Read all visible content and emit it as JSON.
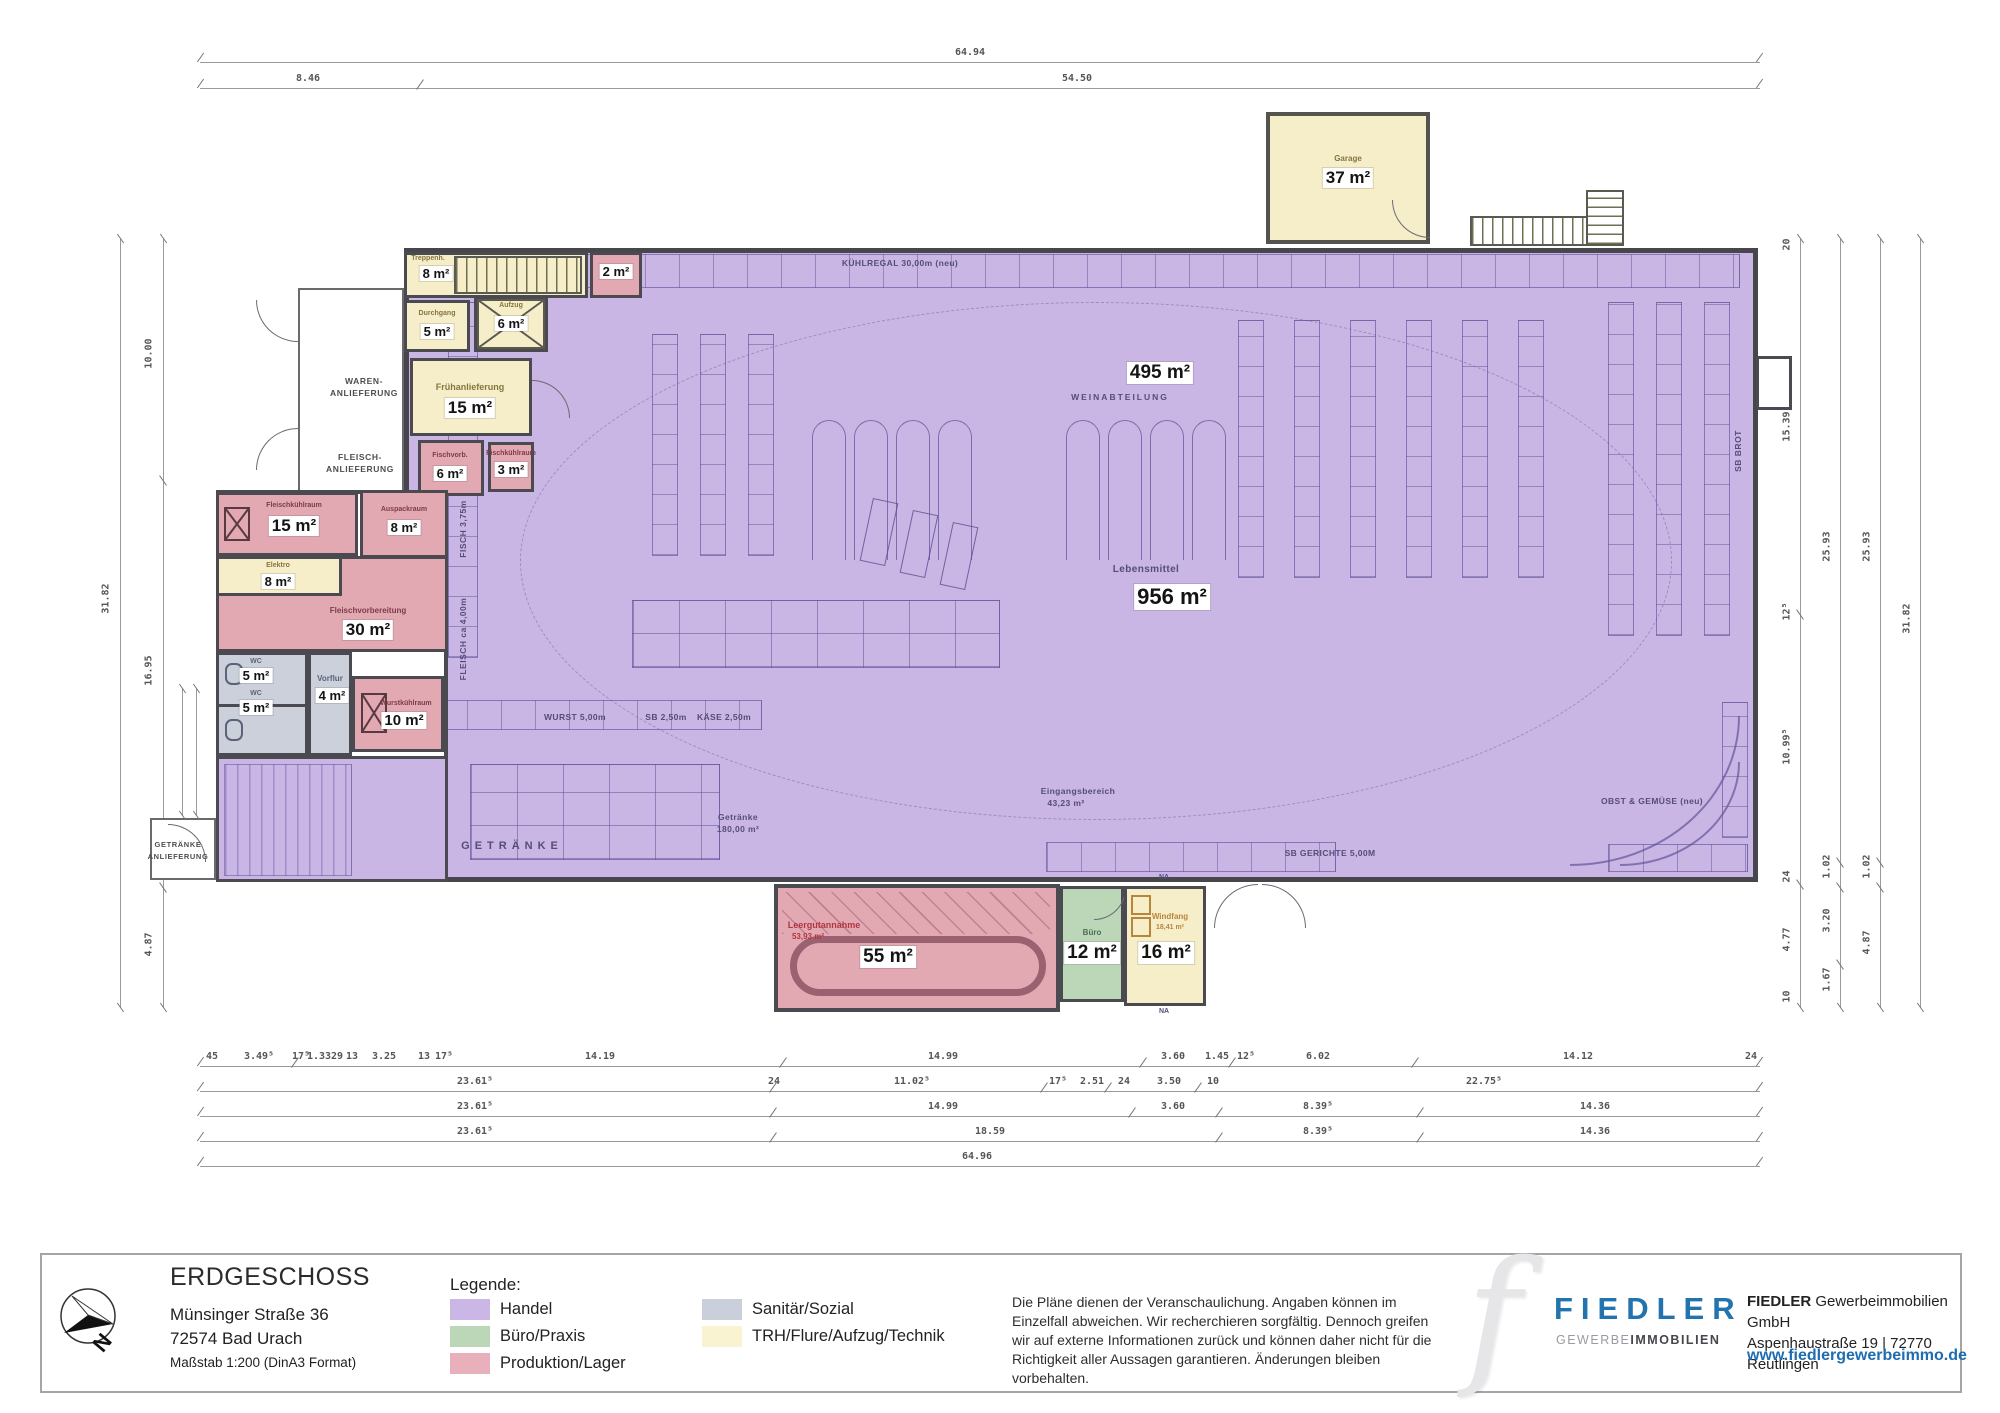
{
  "colors": {
    "handel": "#c9b6e4",
    "buero_praxis": "#bcd6b8",
    "produktion_lager": "#e3a9b3",
    "sanitaer_sozial": "#cbd0da",
    "trh_flure_technik": "#f8f1cf",
    "wall": "#46464c",
    "brand_blue": "#2273ae"
  },
  "plan": {
    "exterior_labels": {
      "waren1": "WAREN-",
      "waren2": "ANLIEFERUNG",
      "fleisch1": "FLEISCH-",
      "fleisch2": "ANLIEFERUNG",
      "getraenke1": "GETRÄNKE",
      "getraenke2": "ANLIEFERUNG"
    },
    "rooms": {
      "treppenhaus": {
        "name": "Treppenh.",
        "area": "8 m²"
      },
      "nebenraum": {
        "area": "2 m²"
      },
      "durchgang": {
        "name": "Durchgang",
        "area": "5 m²"
      },
      "aufzug": {
        "name": "Aufzug",
        "area": "6 m²"
      },
      "fruehanlieferung": {
        "name": "Frühanlieferung",
        "area": "15 m²"
      },
      "fischvorb": {
        "name": "Fischvorb.",
        "area": "6 m²"
      },
      "fischkuehlraum": {
        "name": "Fischkühlraum",
        "area": "3 m²"
      },
      "fleischkuehlraum": {
        "name": "Fleischkühlraum",
        "area": "15 m²"
      },
      "auspackraum": {
        "name": "Auspackraum",
        "area": "8 m²"
      },
      "elektro": {
        "name": "Elektro",
        "area": "8 m²"
      },
      "fleischvorbereitung": {
        "name": "Fleischvorbereitung",
        "area": "30 m²"
      },
      "wc1": {
        "name": "WC",
        "area": "5 m²"
      },
      "wc2": {
        "name": "WC",
        "area": "5 m²"
      },
      "vorflur": {
        "name": "Vorflur",
        "area": "4 m²"
      },
      "wurstkuehlraum": {
        "name": "Wurstkühlraum",
        "area": "10 m²"
      },
      "garage": {
        "name": "Garage",
        "area": "37 m²"
      },
      "leergutannahme": {
        "name": "Leergutannahme",
        "sub": "53,93 m²",
        "area": "55 m²"
      },
      "buero": {
        "name": "Büro",
        "area": "12 m²"
      },
      "windfang": {
        "name": "Windfang",
        "sub": "18,41 m²",
        "area": "16 m²"
      }
    },
    "sales_labels": {
      "handel_area": "495 m²",
      "weinabteilung": "WEINABTEILUNG",
      "lebensmittel_name": "Lebensmittel",
      "lebensmittel_area": "956 m²",
      "kuehlregal": "KÜHLREGAL 30,00m (neu)",
      "fisch": "FISCH 3,75m",
      "fleisch": "FLEISCH ca 4,00m",
      "wurst": "WURST 5,00m",
      "sb": "SB 2,50m",
      "kaese": "KÄSE 2,50m",
      "getraenke_zone": "GETRÄNKE",
      "getraenke_name": "Getränke",
      "getraenke_area": "180,00 m²",
      "eingang_name": "Eingangsbereich",
      "eingang_area": "43,23 m²",
      "sb_gerichte": "SB GERICHTE 5,00M",
      "obst_gemuese": "OBST & GEMÜSE (neu)",
      "sb_brot": "SB BROT",
      "na": "NA"
    },
    "dimensions": {
      "top_total": "64.94",
      "top_segments": [
        "8.46",
        "54.50"
      ],
      "left_total": "31.82",
      "left_segments": [
        "10.00",
        "16.95",
        "4.87"
      ],
      "right_line1": [
        "20",
        "15.39",
        "12⁵",
        "10.99⁵",
        "24",
        "4.77",
        "10"
      ],
      "right_line2": [
        "25.93",
        "1.02",
        "3.20",
        "1.67"
      ],
      "right_line3": [
        "25.93",
        "1.02",
        "4.87"
      ],
      "right_total": "31.82",
      "bottom_row1": [
        "45",
        "3.49⁵",
        "17⁵",
        "1.33",
        "29",
        "13",
        "3.25",
        "13",
        "17⁵",
        "14.19",
        "14.99",
        "3.60",
        "1.45",
        "12⁵",
        "6.02",
        "14.12",
        "24"
      ],
      "bottom_row2": [
        "23.61⁵",
        "24",
        "11.02⁵",
        "17⁵",
        "2.51",
        "24",
        "3.50",
        "10",
        "22.75⁵"
      ],
      "bottom_row3": [
        "23.61⁵",
        "14.99",
        "3.60",
        "8.39⁵",
        "14.36"
      ],
      "bottom_row4": [
        "23.61⁵",
        "18.59",
        "8.39⁵",
        "14.36"
      ],
      "bottom_total": "64.96"
    }
  },
  "footer": {
    "title": "ERDGESCHOSS",
    "address_line1": "Münsinger Straße 36",
    "address_line2": "72574 Bad Urach",
    "scale_note": "Maßstab 1:200 (DinA3 Format)",
    "compass_n": "N",
    "legend": {
      "heading": "Legende:",
      "items": [
        {
          "label": "Handel",
          "color": "#cbb7e5"
        },
        {
          "label": "Büro/Praxis",
          "color": "#bcd6b8"
        },
        {
          "label": "Produktion/Lager",
          "color": "#e8b0ba"
        },
        {
          "label": "Sanitär/Sozial",
          "color": "#c9cfdb"
        },
        {
          "label": "TRH/Flure/Aufzug/Technik",
          "color": "#faf3d2"
        }
      ]
    },
    "disclaimer": "Die Pläne dienen der Veranschaulichung. Angaben können im Einzelfall abweichen. Wir recherchieren sorgfältig. Dennoch greifen wir auf externe Informationen zurück und können daher nicht für die Richtigkeit aller Aussagen garantieren. Änderungen bleiben vorbehalten.",
    "brand": {
      "logo_letter": "f",
      "name": "FIEDLER",
      "sub_gray": "GEWERBE",
      "sub_dark": "IMMOBILIEN",
      "company_bold": "FIEDLER",
      "company_rest": " Gewerbeimmobilien GmbH",
      "company_address": "Aspenhaustraße 19 | 72770 Reutlingen",
      "website": "www.fiedlergewerbeimmo.de"
    }
  }
}
